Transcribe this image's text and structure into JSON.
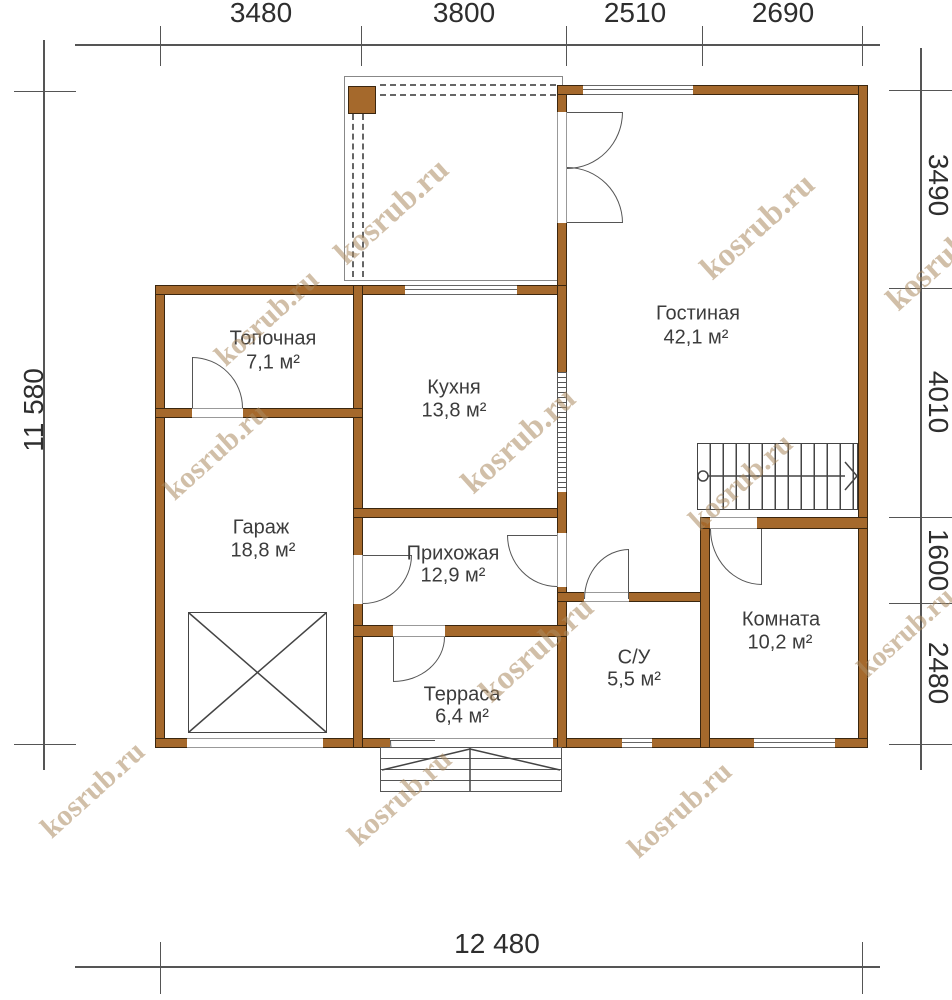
{
  "colors": {
    "wall": "#a5692c",
    "wall_border": "#3a260f",
    "line_dark": "#444444",
    "line_gray": "#666666",
    "dim": "#555555",
    "text": "#3c3c3c",
    "dim_text": "#2e2e2e",
    "watermark": "rgba(172,139,96,0.55)",
    "background": "#ffffff"
  },
  "canvas": {
    "width": 952,
    "height": 1000
  },
  "watermark_text": "kosrub.ru",
  "plan": {
    "porch": {
      "outline": {
        "x": 344,
        "y": 76,
        "w": 219,
        "h": 205
      },
      "post": {
        "x": 348,
        "y": 86,
        "w": 28,
        "h": 28
      },
      "dashes": [
        {
          "x": 380,
          "y": 84,
          "len": 176,
          "dir": "h"
        },
        {
          "x": 380,
          "y": 94,
          "len": 176,
          "dir": "h"
        },
        {
          "x": 352,
          "y": 114,
          "len": 163,
          "dir": "v"
        },
        {
          "x": 362,
          "y": 114,
          "len": 163,
          "dir": "v"
        }
      ]
    },
    "walls": [
      {
        "x": 155,
        "y": 285,
        "w": 10,
        "h": 463
      },
      {
        "x": 155,
        "y": 285,
        "w": 412,
        "h": 10
      },
      {
        "x": 557,
        "y": 85,
        "w": 10,
        "h": 205
      },
      {
        "x": 557,
        "y": 85,
        "w": 311,
        "h": 10
      },
      {
        "x": 858,
        "y": 85,
        "w": 10,
        "h": 663
      },
      {
        "x": 155,
        "y": 738,
        "w": 713,
        "h": 10
      },
      {
        "x": 353,
        "y": 285,
        "w": 10,
        "h": 463
      },
      {
        "x": 155,
        "y": 408,
        "w": 208,
        "h": 10
      },
      {
        "x": 353,
        "y": 508,
        "w": 214,
        "h": 10
      },
      {
        "x": 557,
        "y": 285,
        "w": 10,
        "h": 463
      },
      {
        "x": 557,
        "y": 592,
        "w": 153,
        "h": 10
      },
      {
        "x": 700,
        "y": 517,
        "w": 10,
        "h": 231
      },
      {
        "x": 700,
        "y": 517,
        "w": 168,
        "h": 12
      },
      {
        "x": 353,
        "y": 625,
        "w": 214,
        "h": 12
      }
    ],
    "openings": [
      {
        "x": 557,
        "y": 112,
        "w": 10,
        "h": 111,
        "edges": "lr"
      },
      {
        "x": 192,
        "y": 408,
        "w": 51,
        "h": 10,
        "edges": "tb"
      },
      {
        "x": 353,
        "y": 555,
        "w": 10,
        "h": 49,
        "edges": "lr"
      },
      {
        "x": 557,
        "y": 533,
        "w": 10,
        "h": 54,
        "edges": "lr"
      },
      {
        "x": 584,
        "y": 592,
        "w": 45,
        "h": 10,
        "edges": "tb"
      },
      {
        "x": 710,
        "y": 517,
        "w": 47,
        "h": 12,
        "edges": "tb"
      },
      {
        "x": 393,
        "y": 625,
        "w": 52,
        "h": 12,
        "edges": "tb"
      },
      {
        "x": 187,
        "y": 738,
        "w": 136,
        "h": 10,
        "edges": "tb"
      },
      {
        "x": 390,
        "y": 738,
        "w": 163,
        "h": 10,
        "edges": "tb"
      }
    ],
    "windows": [
      {
        "x": 405,
        "y": 285,
        "w": 112,
        "h": 10
      },
      {
        "x": 583,
        "y": 85,
        "w": 110,
        "h": 10
      },
      {
        "x": 622,
        "y": 738,
        "w": 30,
        "h": 10
      },
      {
        "x": 754,
        "y": 738,
        "w": 81,
        "h": 10
      }
    ],
    "hatch": {
      "x": 557,
      "y": 372,
      "w": 10,
      "h": 120
    },
    "doors": [
      {
        "x": 192,
        "y": 357,
        "w": 51,
        "h": 51,
        "corner": "tr",
        "leaf": "left"
      },
      {
        "x": 567,
        "y": 112,
        "w": 56,
        "h": 57,
        "corner": "br",
        "leaf": "top"
      },
      {
        "x": 567,
        "y": 167,
        "w": 56,
        "h": 56,
        "corner": "tr",
        "leaf": "bottom"
      },
      {
        "x": 363,
        "y": 555,
        "w": 49,
        "h": 49,
        "corner": "br",
        "leaf": "top"
      },
      {
        "x": 507,
        "y": 535,
        "w": 50,
        "h": 52,
        "corner": "bl",
        "leaf": "top"
      },
      {
        "x": 584,
        "y": 549,
        "w": 45,
        "h": 50,
        "corner": "tl",
        "leaf": "right"
      },
      {
        "x": 710,
        "y": 529,
        "w": 52,
        "h": 56,
        "corner": "bl",
        "leaf": "right"
      },
      {
        "x": 393,
        "y": 637,
        "w": 52,
        "h": 45,
        "corner": "br",
        "leaf": "left"
      },
      {
        "x": 390,
        "y": 740,
        "w": 45,
        "h": 52,
        "corner": "bl",
        "leaf": "top"
      }
    ],
    "stairs": {
      "x": 697,
      "y": 443,
      "w": 161,
      "h": 67
    },
    "xbox": {
      "x": 188,
      "y": 612,
      "w": 139,
      "h": 121
    },
    "steps": {
      "x": 380,
      "y": 747,
      "w": 182,
      "h": 45
    },
    "svg_lines": [
      {
        "x1": 189,
        "y1": 613,
        "x2": 326,
        "y2": 732
      },
      {
        "x1": 189,
        "y1": 732,
        "x2": 326,
        "y2": 613
      },
      {
        "x1": 702,
        "y1": 476,
        "x2": 845,
        "y2": 476
      },
      {
        "x1": 845,
        "y1": 462,
        "x2": 857,
        "y2": 476
      },
      {
        "x1": 845,
        "y1": 490,
        "x2": 857,
        "y2": 476
      },
      {
        "x1": 470,
        "y1": 749,
        "x2": 382,
        "y2": 770
      },
      {
        "x1": 470,
        "y1": 749,
        "x2": 560,
        "y2": 770
      },
      {
        "x1": 470,
        "y1": 748,
        "x2": 470,
        "y2": 791
      }
    ],
    "svg_circles": [
      {
        "cx": 703,
        "cy": 476,
        "r": 5
      }
    ]
  },
  "rooms": [
    {
      "name": "Топочная",
      "area": "7,1 м²",
      "nx": 273,
      "ny": 339,
      "ax": 273,
      "ay": 363
    },
    {
      "name": "Кухня",
      "area": "13,8 м²",
      "nx": 454,
      "ny": 388,
      "ax": 454,
      "ay": 411
    },
    {
      "name": "Гостиная",
      "area": "42,1 м²",
      "nx": 698,
      "ny": 314,
      "ax": 696,
      "ay": 338
    },
    {
      "name": "Гараж",
      "area": "18,8 м²",
      "nx": 261,
      "ny": 528,
      "ax": 263,
      "ay": 551
    },
    {
      "name": "Прихожая",
      "area": "12,9 м²",
      "nx": 453,
      "ny": 554,
      "ax": 453,
      "ay": 576
    },
    {
      "name": "Терраса",
      "area": "6,4 м²",
      "nx": 462,
      "ny": 695,
      "ax": 462,
      "ay": 717
    },
    {
      "name": "С/У",
      "area": "5,5 м²",
      "nx": 634,
      "ny": 658,
      "ax": 634,
      "ay": 680
    },
    {
      "name": "Комната",
      "area": "10,2 м²",
      "nx": 781,
      "ny": 620,
      "ax": 780,
      "ay": 643
    }
  ],
  "dimensions": {
    "lines": [
      {
        "x": 75,
        "y": 44,
        "w": 805,
        "h": 2
      },
      {
        "x": 75,
        "y": 966,
        "w": 805,
        "h": 2
      },
      {
        "x": 43,
        "y": 40,
        "w": 2,
        "h": 730
      },
      {
        "x": 920,
        "y": 48,
        "w": 2,
        "h": 722
      },
      {
        "x": 160,
        "y": 26,
        "w": 1,
        "h": 40
      },
      {
        "x": 361,
        "y": 26,
        "w": 1,
        "h": 40
      },
      {
        "x": 566,
        "y": 26,
        "w": 1,
        "h": 40
      },
      {
        "x": 702,
        "y": 26,
        "w": 1,
        "h": 40
      },
      {
        "x": 862,
        "y": 26,
        "w": 1,
        "h": 40
      },
      {
        "x": 160,
        "y": 942,
        "w": 1,
        "h": 52
      },
      {
        "x": 862,
        "y": 942,
        "w": 1,
        "h": 52
      },
      {
        "x": 14,
        "y": 91,
        "w": 62,
        "h": 1
      },
      {
        "x": 14,
        "y": 744,
        "w": 62,
        "h": 1
      },
      {
        "x": 889,
        "y": 90,
        "w": 63,
        "h": 1
      },
      {
        "x": 889,
        "y": 288,
        "w": 63,
        "h": 1
      },
      {
        "x": 889,
        "y": 517,
        "w": 63,
        "h": 1
      },
      {
        "x": 889,
        "y": 603,
        "w": 63,
        "h": 1
      },
      {
        "x": 889,
        "y": 744,
        "w": 63,
        "h": 1
      }
    ],
    "labels": [
      {
        "text": "3480",
        "x": 261,
        "y": 13,
        "rot": 0
      },
      {
        "text": "3800",
        "x": 464,
        "y": 13,
        "rot": 0
      },
      {
        "text": "2510",
        "x": 635,
        "y": 13,
        "rot": 0
      },
      {
        "text": "2690",
        "x": 783,
        "y": 13,
        "rot": 0
      },
      {
        "text": "12 480",
        "x": 497,
        "y": 944,
        "rot": 0
      },
      {
        "text": "11 580",
        "x": 34,
        "y": 410,
        "rot": -90
      },
      {
        "text": "3490",
        "x": 938,
        "y": 185,
        "rot": 90
      },
      {
        "text": "4010",
        "x": 938,
        "y": 402,
        "rot": 90
      },
      {
        "text": "1600",
        "x": 938,
        "y": 560,
        "rot": 90
      },
      {
        "text": "2480",
        "x": 938,
        "y": 673,
        "rot": 90
      }
    ]
  },
  "watermarks": [
    {
      "x": 267,
      "y": 318,
      "size": 30
    },
    {
      "x": 392,
      "y": 212,
      "size": 33
    },
    {
      "x": 758,
      "y": 227,
      "size": 33
    },
    {
      "x": 944,
      "y": 258,
      "size": 33
    },
    {
      "x": 216,
      "y": 452,
      "size": 30
    },
    {
      "x": 519,
      "y": 441,
      "size": 33
    },
    {
      "x": 741,
      "y": 482,
      "size": 30
    },
    {
      "x": 537,
      "y": 650,
      "size": 33
    },
    {
      "x": 906,
      "y": 633,
      "size": 28
    },
    {
      "x": 93,
      "y": 790,
      "size": 30
    },
    {
      "x": 400,
      "y": 798,
      "size": 30
    },
    {
      "x": 680,
      "y": 810,
      "size": 30
    }
  ]
}
